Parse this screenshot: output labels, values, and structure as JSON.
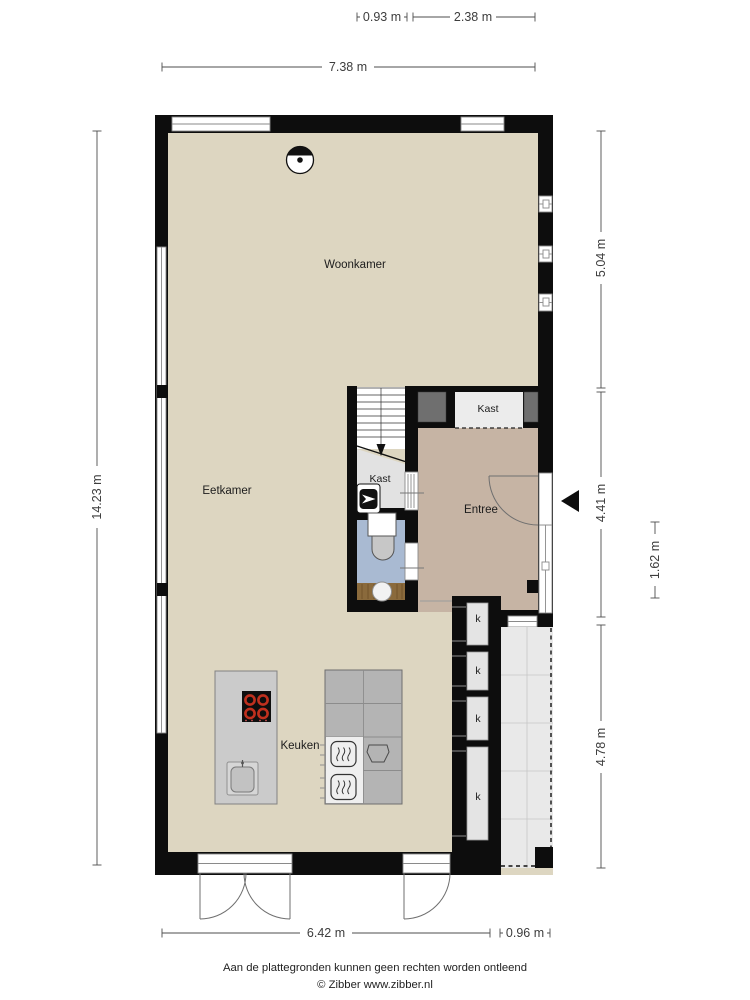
{
  "plan": {
    "rooms": {
      "woonkamer": {
        "label": "Woonkamer"
      },
      "eetkamer": {
        "label": "Eetkamer"
      },
      "keuken": {
        "label": "Keuken"
      },
      "entree": {
        "label": "Entree"
      },
      "kast_stairs": {
        "label": "Kast"
      },
      "kast_hall": {
        "label": "Kast"
      },
      "closets": {
        "c1": "k",
        "c2": "k",
        "c3": "k",
        "c4": "k"
      }
    },
    "dimensions": {
      "top_stairs_width": "0.93 m",
      "top_entree_width": "2.38 m",
      "top_total_width": "7.38 m",
      "left_total_depth": "14.23 m",
      "right_woonkamer_depth": "5.04 m",
      "right_entree_depth": "4.41 m",
      "right_door_section": "1.62 m",
      "right_patio_depth": "4.78 m",
      "bottom_main_width": "6.42 m",
      "bottom_patio_width": "0.96 m"
    }
  },
  "footer": {
    "disclaimer": "Aan de plattegronden kunnen geen rechten worden ontleend",
    "copyright": "© Zibber www.zibber.nl"
  },
  "colors": {
    "wall": "#0d0d0d",
    "floor_main": "#ddd6c1",
    "floor_entree": "#c6b4a4",
    "floor_closet": "#e9e9e9",
    "floor_toilet": "#a9bad2",
    "counter_wood": "#8a6a3c",
    "kitchen_island": "#cbcbcb",
    "kitchen_counter": "#b4b4b4",
    "patio_tile": "#e9e9e9",
    "cabinet_dark": "#6f6f6f",
    "burner_red": "#c0301e",
    "dimension_text": "#3d3d3d"
  }
}
